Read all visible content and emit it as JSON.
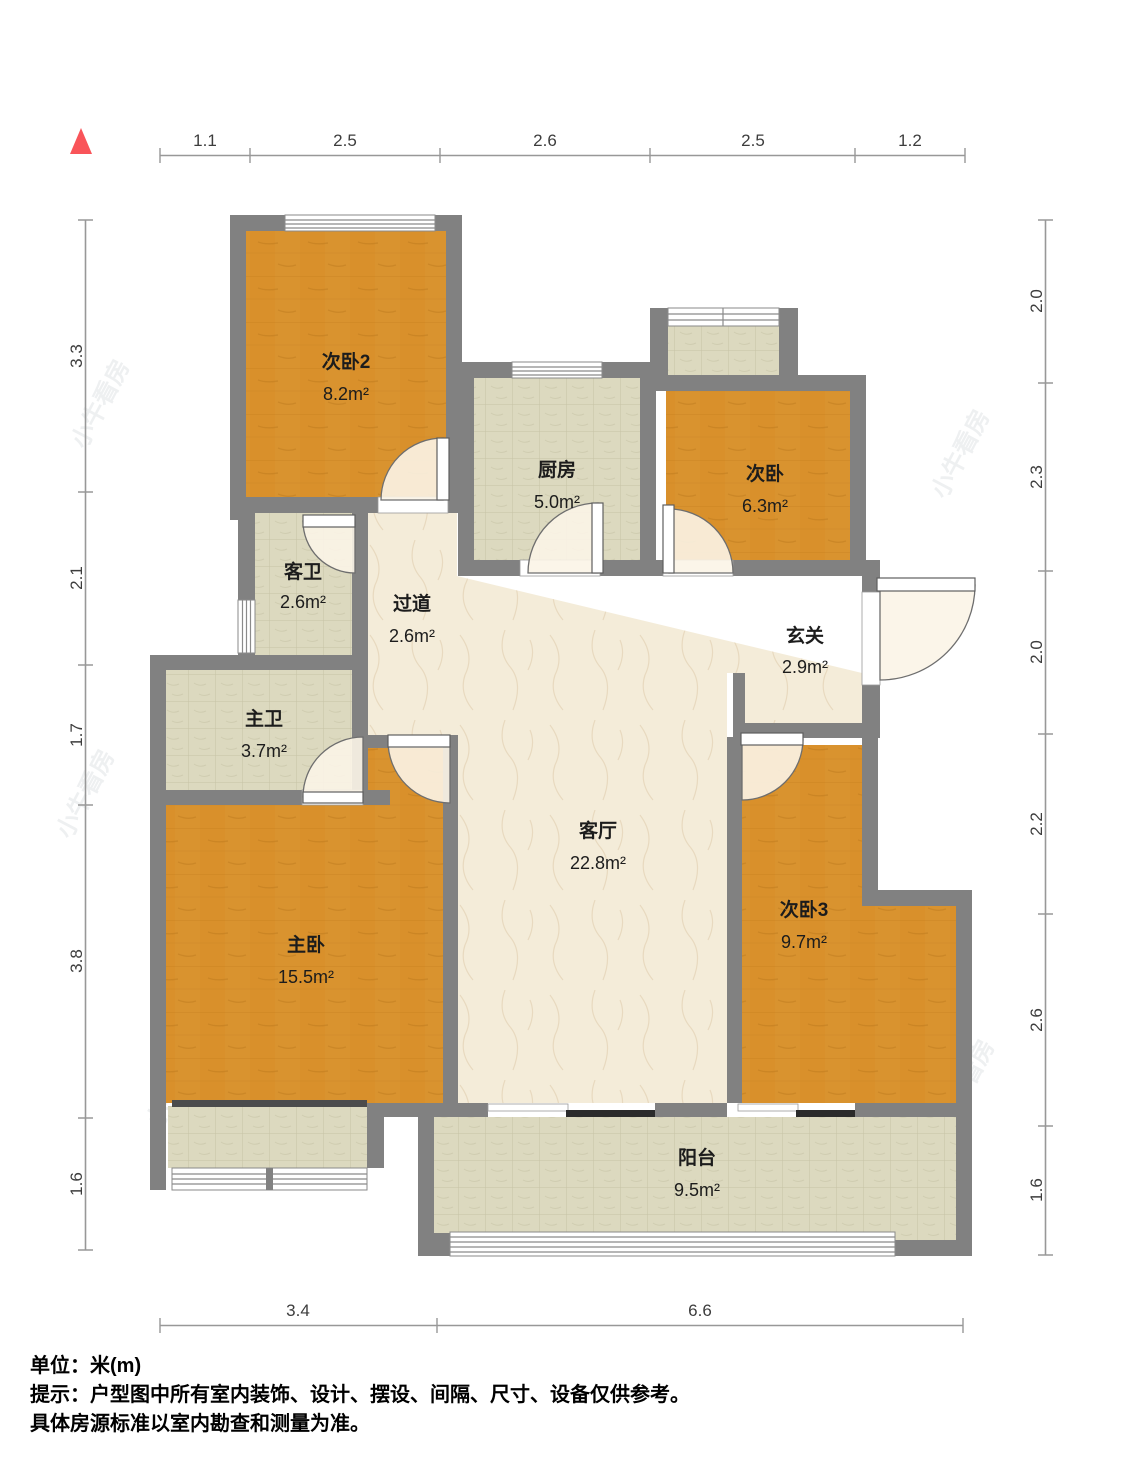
{
  "north_indicator": "north-triangle",
  "watermark": {
    "text": "小牛看房"
  },
  "dimensions": {
    "top": [
      "1.1",
      "2.5",
      "2.6",
      "2.5",
      "1.2"
    ],
    "bottom": [
      "3.4",
      "6.6"
    ],
    "left": [
      "3.3",
      "2.1",
      "1.7",
      "3.8",
      "1.6"
    ],
    "right": [
      "2.0",
      "2.3",
      "2.0",
      "2.2",
      "2.6",
      "1.6"
    ]
  },
  "rooms": [
    {
      "id": "bedroom2",
      "name": "次卧2",
      "area": "8.2m²"
    },
    {
      "id": "kitchen",
      "name": "厨房",
      "area": "5.0m²"
    },
    {
      "id": "bedroom",
      "name": "次卧",
      "area": "6.3m²"
    },
    {
      "id": "guest-bath",
      "name": "客卫",
      "area": "2.6m²"
    },
    {
      "id": "hallway",
      "name": "过道",
      "area": "2.6m²"
    },
    {
      "id": "entry",
      "name": "玄关",
      "area": "2.9m²"
    },
    {
      "id": "master-bath",
      "name": "主卫",
      "area": "3.7m²"
    },
    {
      "id": "living",
      "name": "客厅",
      "area": "22.8m²"
    },
    {
      "id": "master",
      "name": "主卧",
      "area": "15.5m²"
    },
    {
      "id": "bedroom3",
      "name": "次卧3",
      "area": "9.7m²"
    },
    {
      "id": "balcony",
      "name": "阳台",
      "area": "9.5m²"
    }
  ],
  "footer": {
    "line1": "单位：米(m)",
    "line2": "提示：户型图中所有室内装饰、设计、摆设、间隔、尺寸、设备仅供参考。",
    "line3": "具体房源标准以室内勘查和测量为准。"
  },
  "colors": {
    "wall": "#818181",
    "wood": "#d9932f",
    "tile": "#dcd9bf",
    "marble": "#f4ecd9",
    "north": "#f95459",
    "dark_sill": "#4c4c4c",
    "slider": "#2b2b2b",
    "swing": "#fbf4e7",
    "dim_line": "#989898",
    "dim_text": "#3d3d3d"
  }
}
